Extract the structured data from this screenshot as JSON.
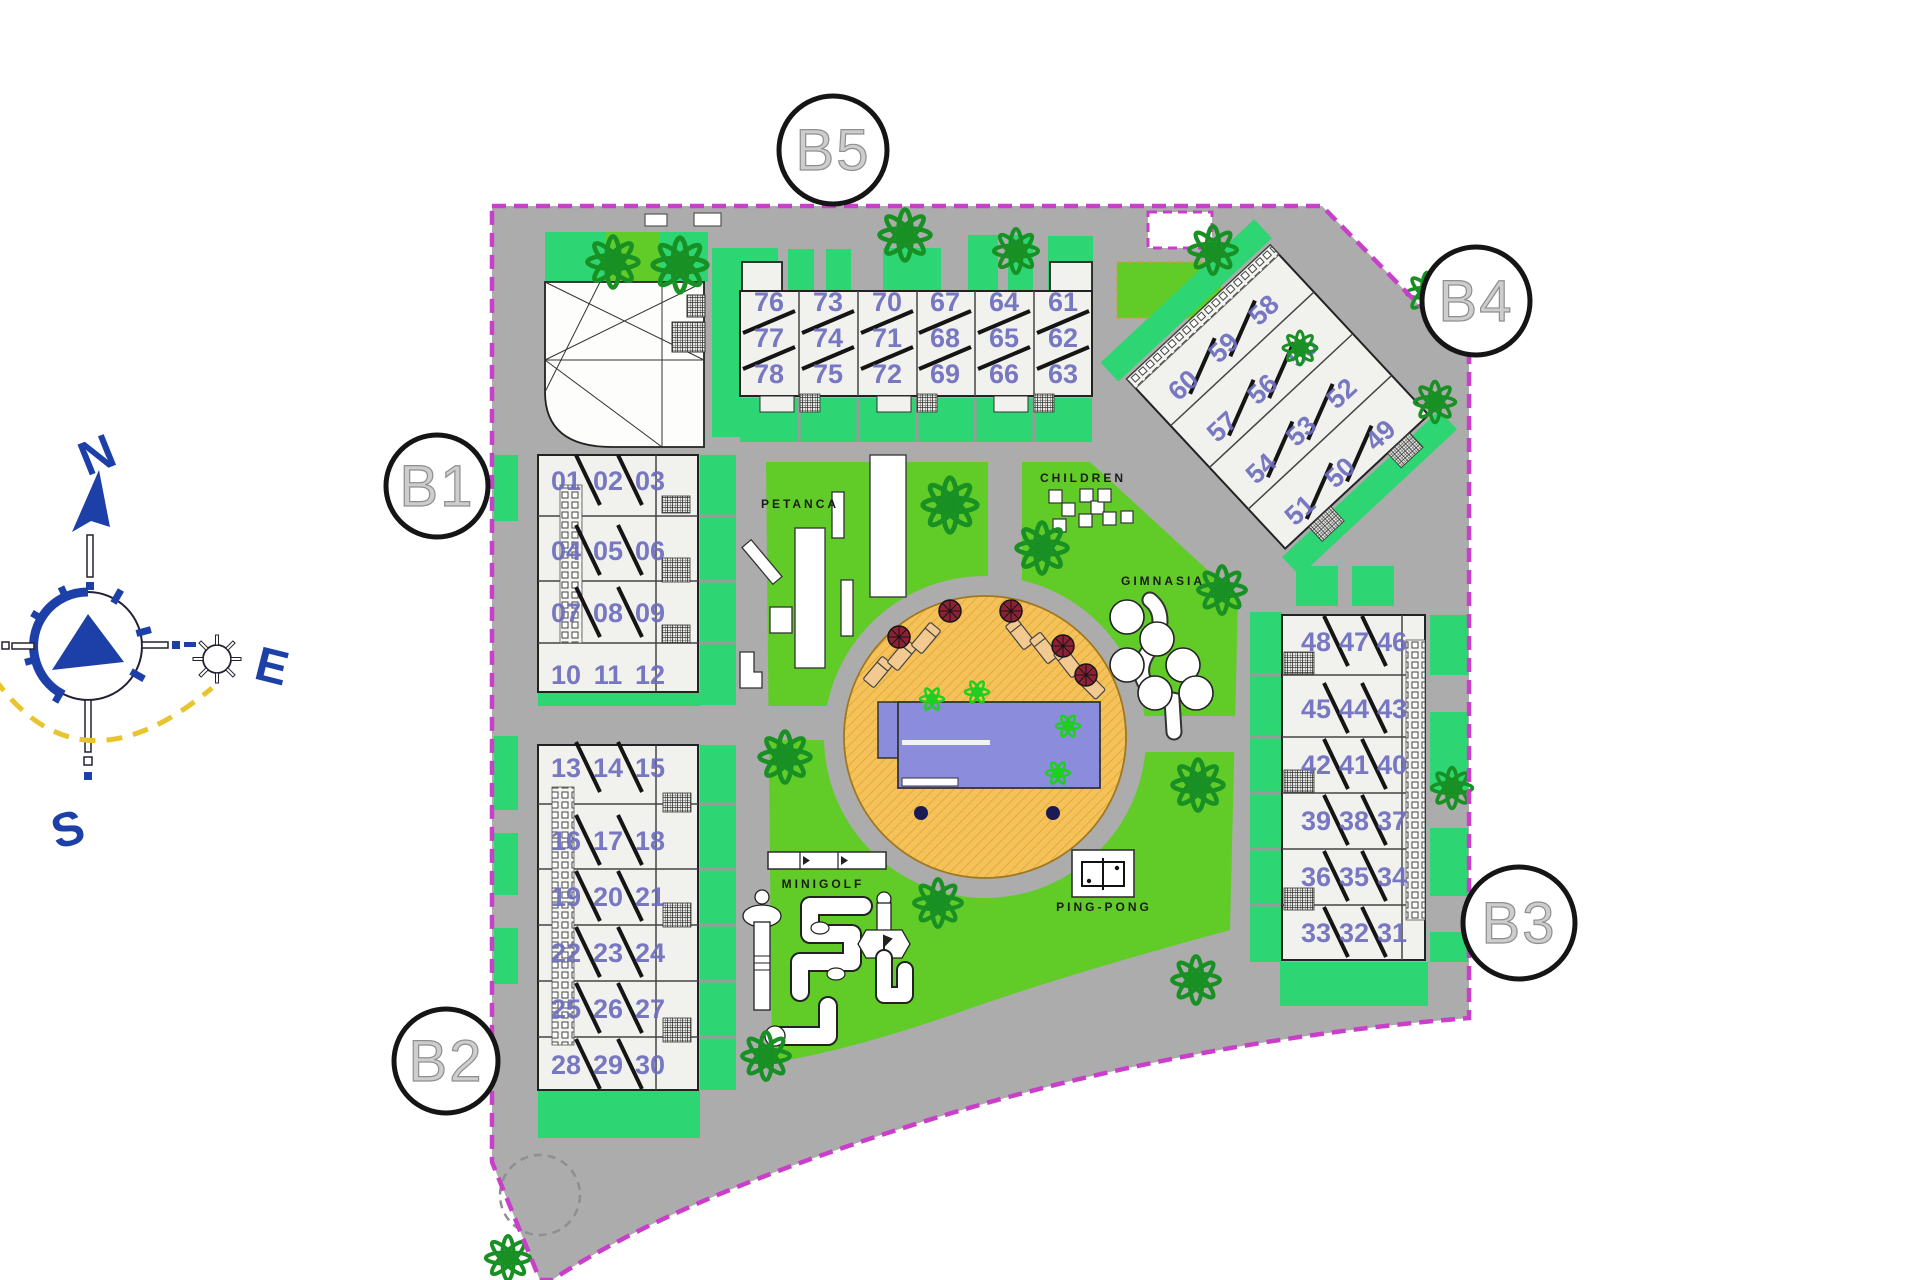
{
  "plan": {
    "blocks": {
      "b1": "B1",
      "b2": "B2",
      "b3": "B3",
      "b4": "B4",
      "b5": "B5"
    },
    "amenities": {
      "petanca": "PETANCA",
      "children": "CHILDREN",
      "gimnasia": "GIMNASIA",
      "minigolf": "MINIGOLF",
      "pingpong": "PING-PONG"
    },
    "compass": {
      "n": "N",
      "e": "E",
      "s": "S"
    },
    "units": {
      "b5": [
        [
          "76",
          "77",
          "78"
        ],
        [
          "73",
          "74",
          "75"
        ],
        [
          "70",
          "71",
          "72"
        ],
        [
          "67",
          "68",
          "69"
        ],
        [
          "64",
          "65",
          "66"
        ],
        [
          "61",
          "62",
          "63"
        ]
      ],
      "b4": [
        [
          "60",
          "59",
          "58"
        ],
        [
          "57",
          "56",
          "55"
        ],
        [
          "54",
          "53",
          "52"
        ],
        [
          "51",
          "50",
          "49"
        ]
      ],
      "b1": [
        [
          "01",
          "02",
          "03"
        ],
        [
          "04",
          "05",
          "06"
        ],
        [
          "07",
          "08",
          "09"
        ],
        [
          "10",
          "11",
          "12"
        ]
      ],
      "b2": [
        [
          "13",
          "14",
          "15"
        ],
        [
          "16",
          "17",
          "18"
        ],
        [
          "19",
          "20",
          "21"
        ],
        [
          "22",
          "23",
          "24"
        ],
        [
          "25",
          "26",
          "27"
        ],
        [
          "28",
          "29",
          "30"
        ]
      ],
      "b3": [
        [
          "48",
          "47",
          "46"
        ],
        [
          "45",
          "44",
          "43"
        ],
        [
          "42",
          "41",
          "40"
        ],
        [
          "39",
          "38",
          "37"
        ],
        [
          "36",
          "35",
          "34"
        ],
        [
          "33",
          "32",
          "31"
        ]
      ]
    },
    "colors": {
      "boundary": "#C93FC9",
      "road": "#ACACAC",
      "lawn": "#61CB28",
      "hedge": "#2ED573",
      "building": "#F1F1ED",
      "unit_number": "#6C6CBE",
      "pool_water": "#8C8CDC",
      "pool_deck": "#F5C25A",
      "compass_blue": "#1C40A8",
      "tree": "#189024",
      "palm": "#1FCF1F",
      "umbrella": "#8E2136",
      "lounger": "#F2C98F",
      "sun_path": "#E8C42E"
    }
  }
}
